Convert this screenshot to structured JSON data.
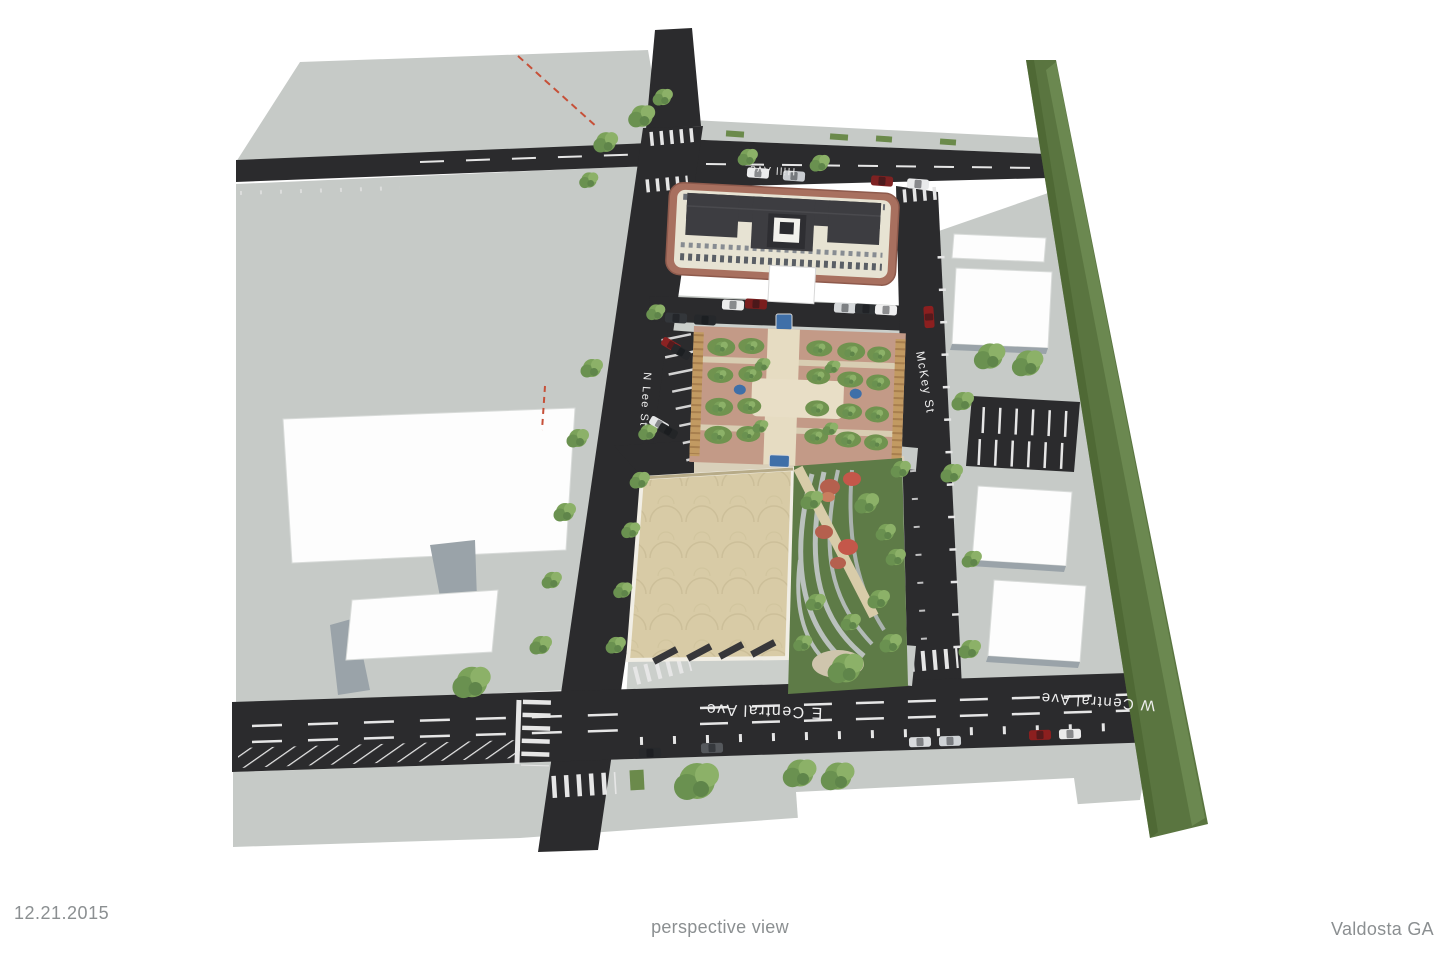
{
  "meta": {
    "date": "12.21.2015",
    "view_label": "perspective view",
    "location": "Valdosta GA"
  },
  "streets": {
    "hill": "Hill Ave",
    "n_lee": "N Lee St",
    "mckey": "McKey St",
    "e_central": "E Central Ave",
    "w_central": "W Central Ave"
  },
  "colors": {
    "road": "#2b2b2d",
    "plane_gray": "#c6cac7",
    "green_strip": "#5a7540",
    "plaza_paving": "#c39a87",
    "tan_roof": "#d8cba6",
    "brick": "#a8705f",
    "marking_white": "#e6e6e6",
    "fountain_blue": "#3f6fa8",
    "text_gray": "#8b8f91"
  }
}
